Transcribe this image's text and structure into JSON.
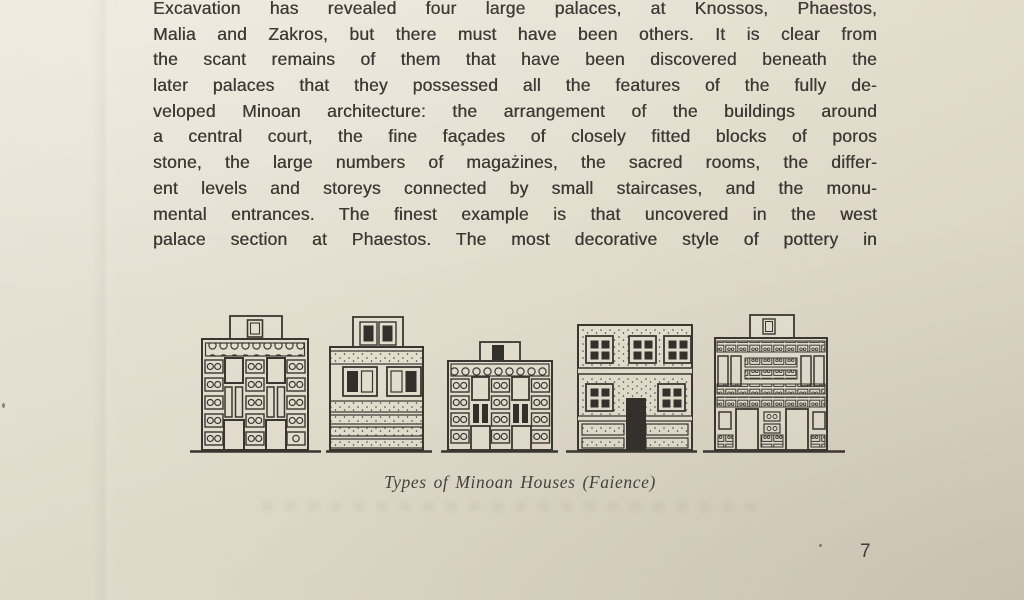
{
  "document": {
    "paragraph_lines": [
      "Excavation has revealed four large palaces, at Knossos, Phaestos,",
      "Malia and Zakros, but there must have been others. It is clear from",
      "the scant remains of them that have been discovered beneath the",
      "later palaces that they possessed all the features of the fully de-",
      "veloped Minoan architecture: the arrangement of the buildings around",
      "a central court, the fine façades of closely fitted blocks of poros",
      "stone, the large numbers of magażines, the sacred rooms, the differ-",
      "ent levels and storeys connected by small staircases, and the monu-",
      "mental entrances. The finest example is that uncovered in the west",
      "palace section at Phaestos. The most decorative style of pottery in"
    ],
    "figure_caption": "Types of Minoan Houses (Faience)",
    "page_number": "7"
  },
  "colors": {
    "paper": "#e7e1d2",
    "ink": "#35322d"
  }
}
